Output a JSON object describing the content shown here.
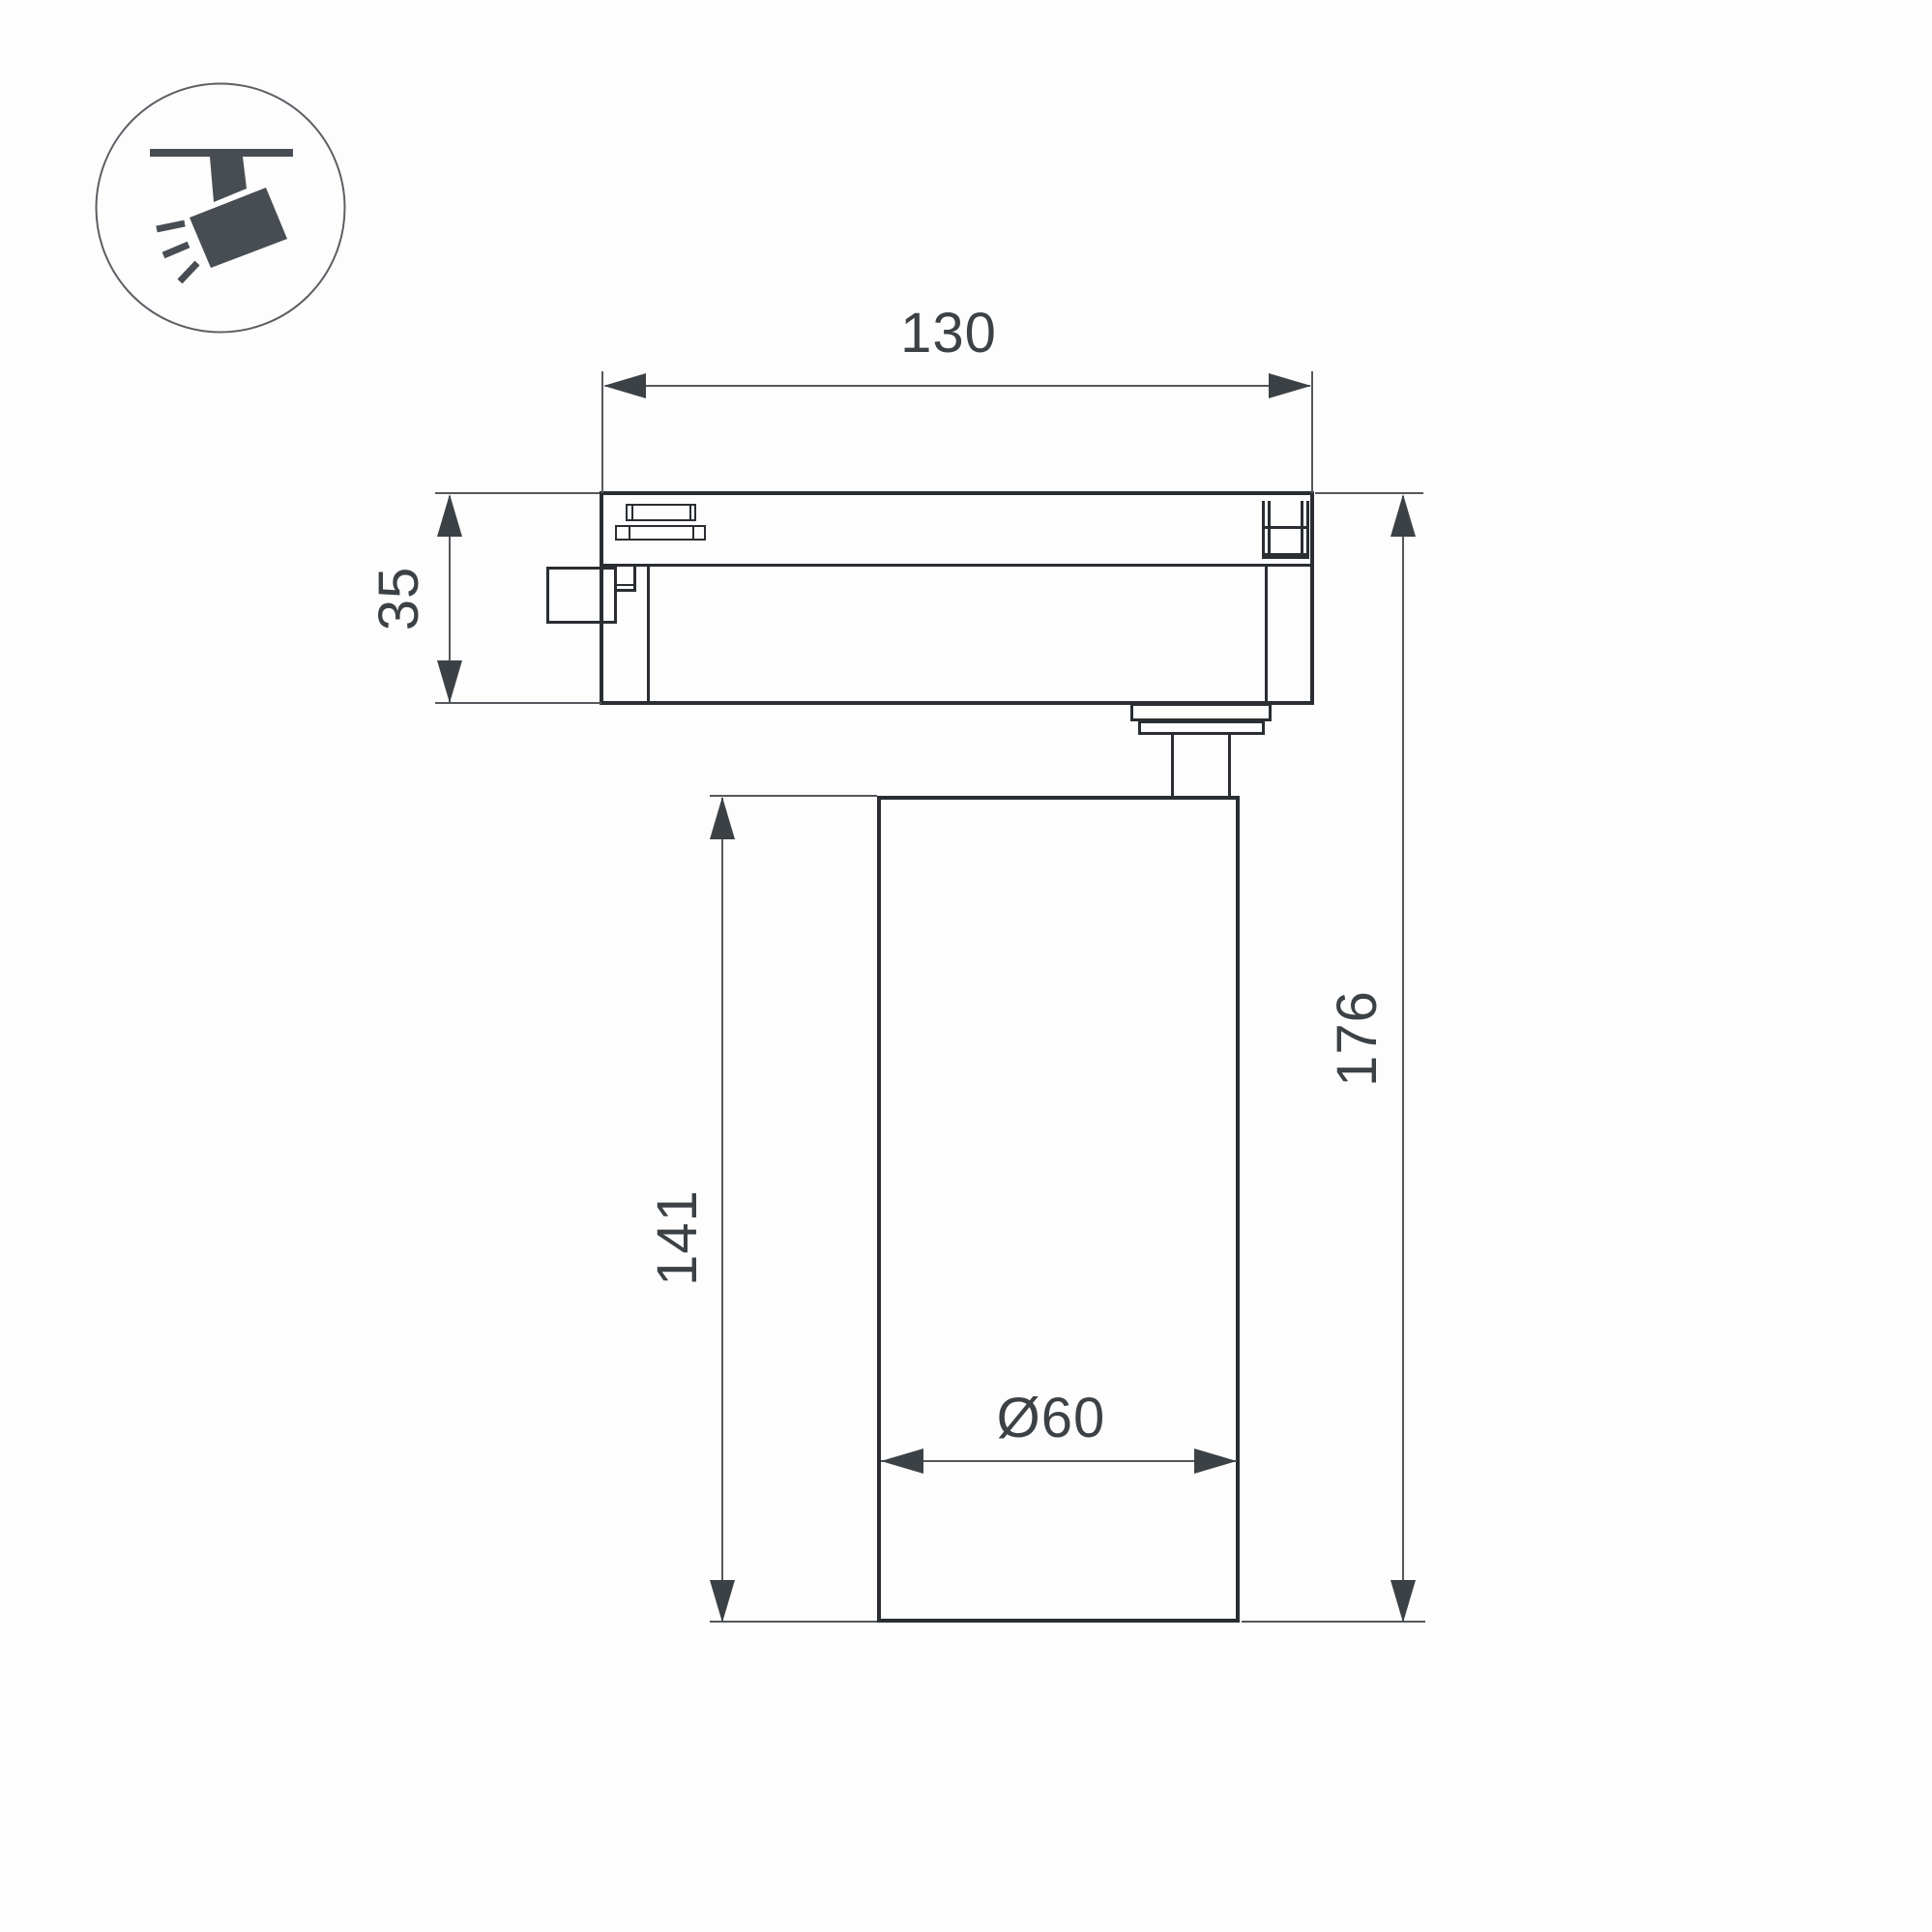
{
  "icon": {
    "name": "ceiling-track-spotlight",
    "color": "#474d53",
    "circle_stroke": "#5b6065"
  },
  "dimensions": {
    "adapter_width": "130",
    "adapter_height": "35",
    "body_height": "141",
    "total_height": "176",
    "body_diameter": "Ø60"
  },
  "colors": {
    "outline": "#2a2e32",
    "dimension_line": "#54585c",
    "text": "#3c4145",
    "background": "#fdfdfd"
  }
}
